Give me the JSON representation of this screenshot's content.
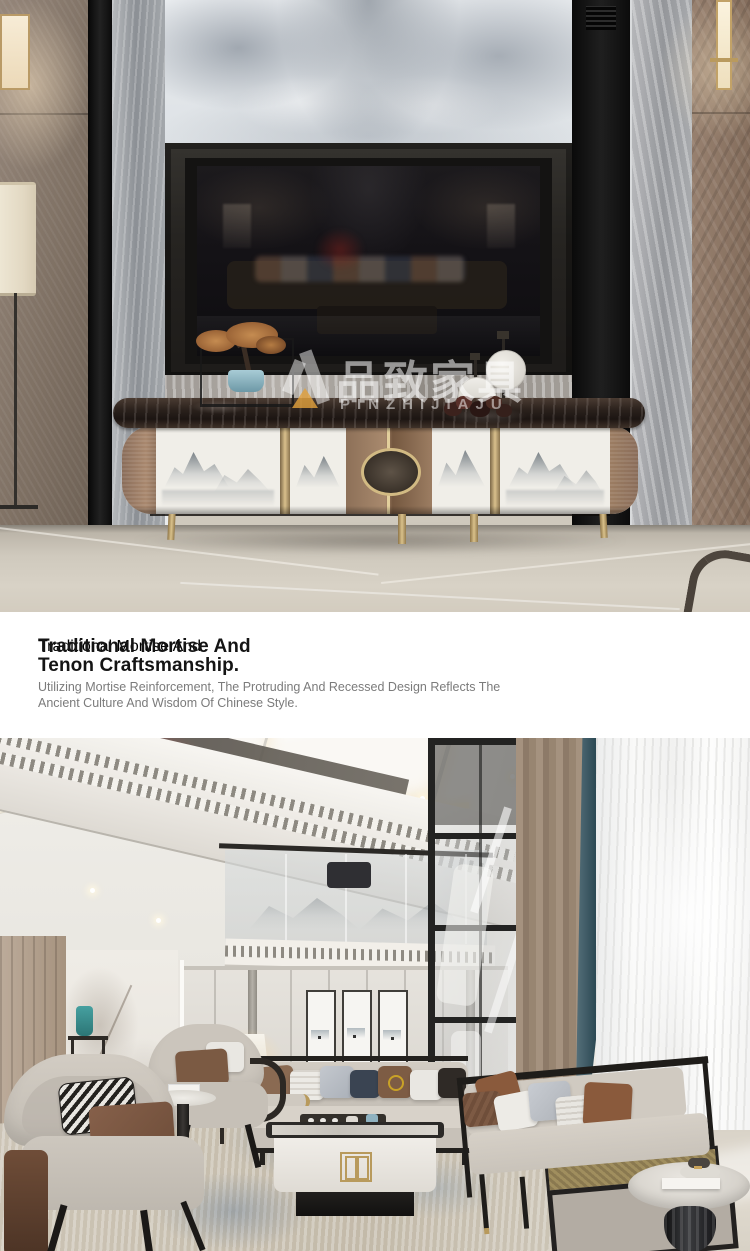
{
  "canvas": {
    "width": 750,
    "height": 1251
  },
  "brand_watermark": {
    "mark": "V",
    "name_cn": "品致家具",
    "name_en": "PINZHIJIAJU",
    "triangle_color": "#e0a03c",
    "text_color": "rgba(255,255,255,0.55)"
  },
  "feature_text": {
    "heading_lines": [
      "Traditional Mortise And",
      "Tenon Craftsmanship."
    ],
    "body_lines": [
      "Utilizing Mortise Reinforcement, The Protruding And Recessed Design Reflects The",
      "Ancient Culture And Wisdom Of Chinese Style."
    ],
    "heading_color": "#141414",
    "body_color": "#7b7b7b",
    "background": "#ffffff"
  },
  "palette": {
    "bronze_accent": "#a3846c",
    "gold_trim": "#cdb886",
    "dark_marble_top": "#241c18",
    "teal_curtain": "#2d4a55",
    "rug_blue": "#6e8aa8",
    "floor_beige": "#d5cfc4"
  }
}
